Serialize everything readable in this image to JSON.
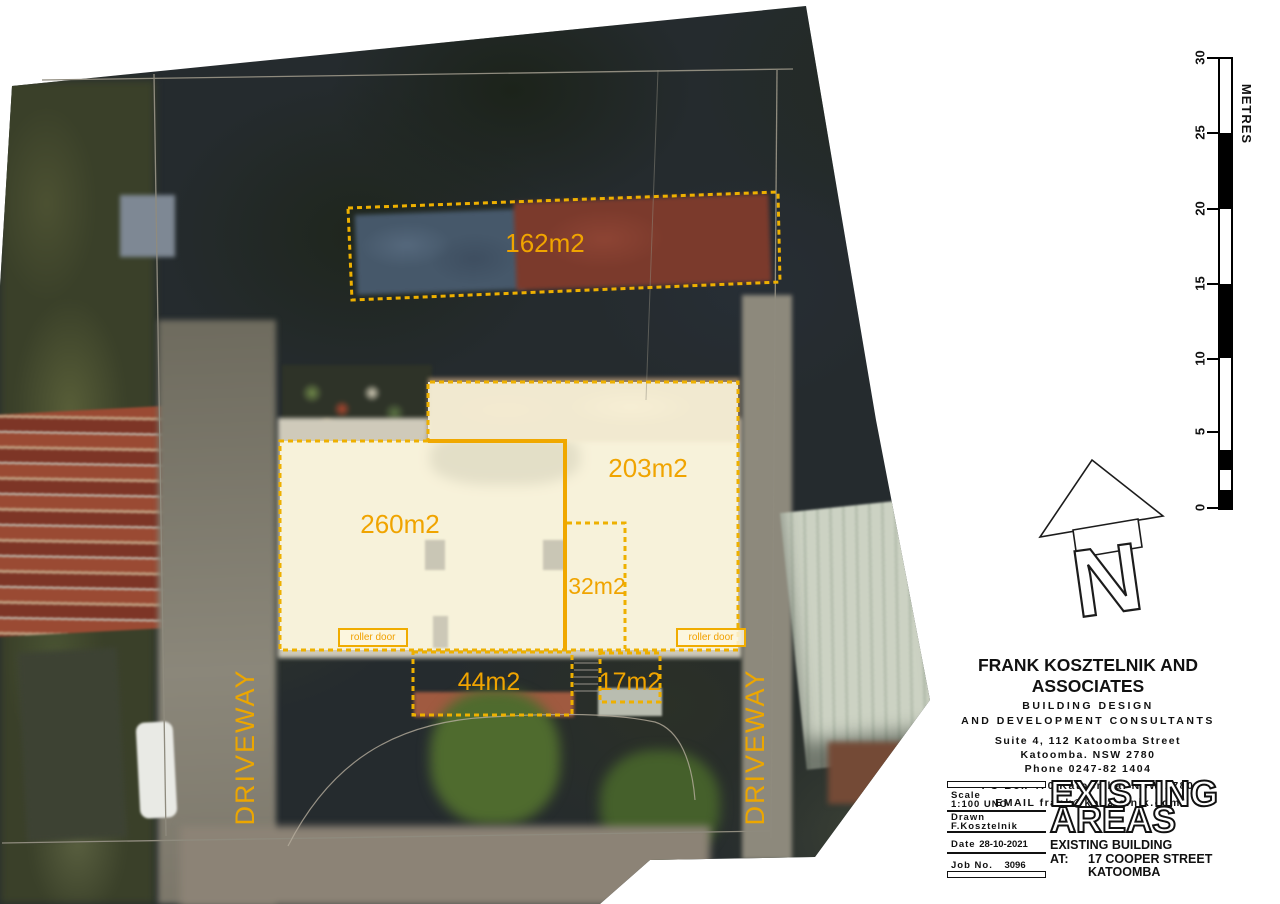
{
  "plan": {
    "areas": [
      {
        "id": "162",
        "label": "162m2"
      },
      {
        "id": "203",
        "label": "203m2"
      },
      {
        "id": "260",
        "label": "260m2"
      },
      {
        "id": "32",
        "label": "32m2"
      },
      {
        "id": "44",
        "label": "44m2"
      },
      {
        "id": "17",
        "label": "17m2"
      }
    ],
    "roller_door_label": "roller door",
    "driveway_label": "DRIVEWAY"
  },
  "scale_bar": {
    "unit": "METRES",
    "ticks": [
      "30",
      "25",
      "20",
      "15",
      "10",
      "5",
      "0"
    ]
  },
  "north": {
    "letter": "N"
  },
  "firm": {
    "name": "FRANK KOSZTELNIK AND ASSOCIATES",
    "line1": "BUILDING DESIGN",
    "line2": "AND DEVELOPMENT CONSULTANTS",
    "address1": "Suite 4, 112 Katoomba Street",
    "address2": "Katoomba. NSW 2780",
    "phone": "Phone 0247-82 1404",
    "po_box": "PO Box 470 Katoomba. NSW 2780",
    "email": "EMAIL frank@kosztelnik.com"
  },
  "title_block": {
    "scale_label": "Scale",
    "scale_value": "1:100 UNO",
    "drawn_label": "Drawn",
    "drawn_value": "F.Kosztelnik",
    "date_label": "Date",
    "date_value": "28-10-2021",
    "job_label": "Job No.",
    "job_value": "3096",
    "sheet_title_line1": "EXISTING",
    "sheet_title_line2": "AREAS",
    "project_line1": "EXISTING BUILDING",
    "at_label": "AT:",
    "project_street": "17 COOPER STREET",
    "project_city": "KATOOMBA"
  },
  "colors": {
    "accent_orange": "#F0A800",
    "dashed_line": "#EEB000",
    "overlay_cream": "#FBF4DC",
    "boundary_gray": "#8F8B7E"
  }
}
